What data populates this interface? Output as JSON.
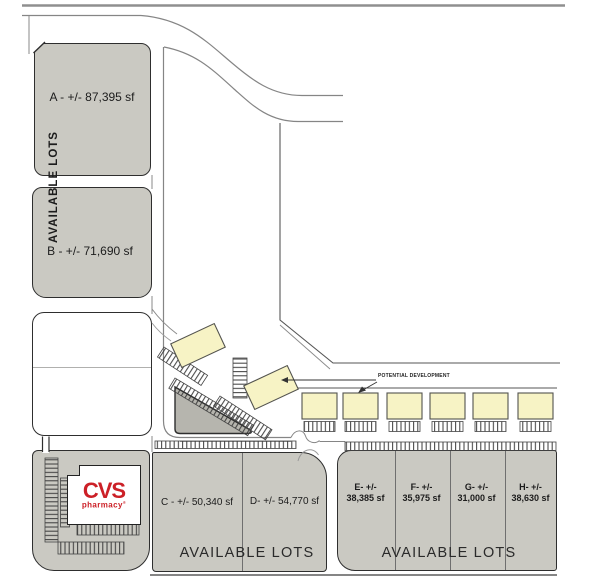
{
  "plan": {
    "colors": {
      "lot_gray": "#cac9c2",
      "building_cream": "#f7f3c5",
      "triangle_gray": "#b6b5ae",
      "cvs_red": "#cc2027"
    },
    "lot_a_label": "A - +/- 87,395 sf",
    "lot_b_label": "B - +/- 71,690 sf",
    "available_lots_vertical": "AVAILABLE LOTS",
    "lot_c_label": "C - +/- 50,340 sf",
    "lot_d_label": "D- +/- 54,770 sf",
    "available_lots_cd": "AVAILABLE LOTS",
    "lots_eh": [
      {
        "line1": "E- +/-",
        "line2": "38,385 sf"
      },
      {
        "line1": "F- +/-",
        "line2": "35,975 sf"
      },
      {
        "line1": "G- +/-",
        "line2": "31,000 sf"
      },
      {
        "line1": "H- +/-",
        "line2": "38,630 sf"
      }
    ],
    "available_lots_eh": "AVAILABLE LOTS",
    "potential_development_label": "POTENTIAL DEVELOPMENT",
    "cvs_wordmark": "CVS",
    "cvs_sub": "pharmacy",
    "cvs_reg": "®"
  }
}
